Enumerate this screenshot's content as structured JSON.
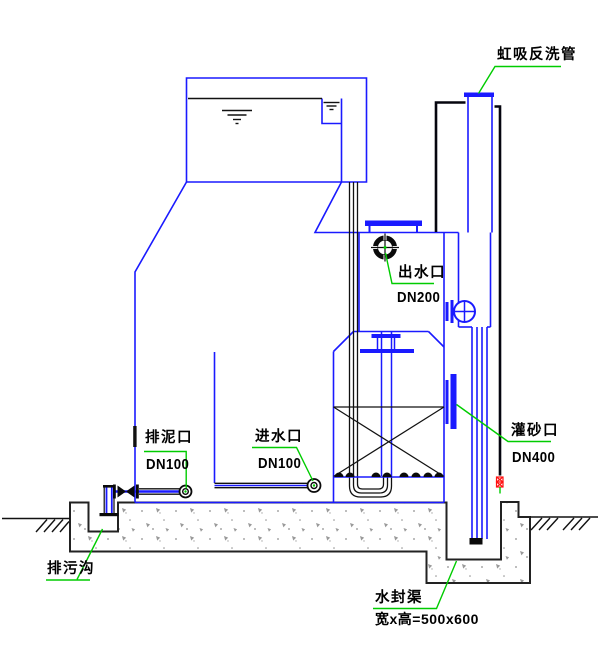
{
  "drawing": {
    "kind": "siphon-filter-tank-section",
    "labels": {
      "siphon_pipe": "虹吸反洗管",
      "outlet_name": "出水口",
      "outlet_size": "DN200",
      "sludge_name": "排泥口",
      "sludge_size": "DN100",
      "inlet_name": "进水口",
      "inlet_size": "DN100",
      "sand_name": "灌砂口",
      "sand_size": "DN400",
      "ditch_name": "排污沟",
      "seal_name": "水封渠",
      "seal_dim": "宽x高=500x600"
    },
    "colors": {
      "structure_blue": "#1a1aff",
      "leader_green": "#00cc00",
      "line_black": "#0a0a0a",
      "mark_red": "#ff1111",
      "concrete_gray": "#8f8f8f"
    }
  }
}
